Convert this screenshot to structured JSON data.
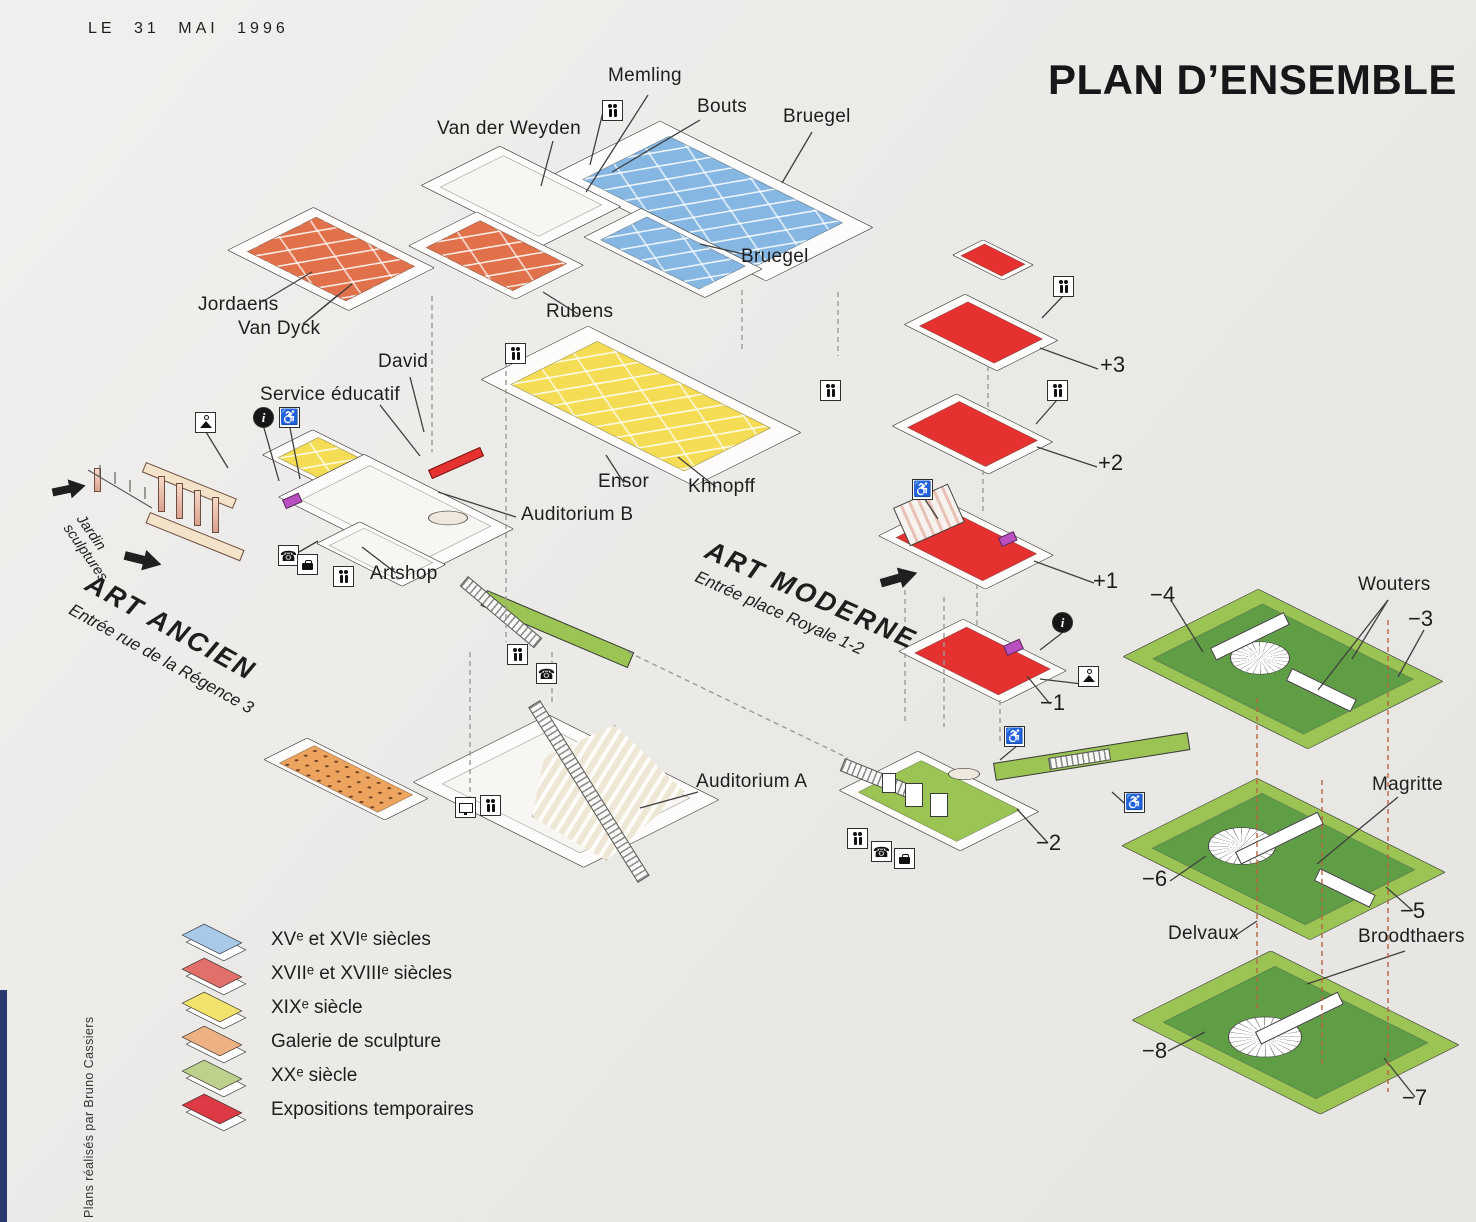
{
  "page": {
    "date": "LE 31 MAI 1996",
    "title": "PLAN D’ENSEMBLE",
    "credit": "Plans réalisés par Bruno Cassiers"
  },
  "art_ancien": {
    "name": "ART ANCIEN",
    "entrance": "Entrée rue de la Régence 3",
    "garden": "Jardin sculptures",
    "rooms": {
      "memling": "Memling",
      "bouts": "Bouts",
      "bruegel_top": "Bruegel",
      "van_der_weyden": "Van der Weyden",
      "bruegel_lower": "Bruegel",
      "jordaens": "Jordaens",
      "van_dyck": "Van Dyck",
      "rubens": "Rubens",
      "david": "David",
      "service_educatif": "Service éducatif",
      "ensor": "Ensor",
      "khnopff": "Khnopff",
      "auditorium_b": "Auditorium B",
      "artshop": "Artshop",
      "auditorium_a": "Auditorium A"
    }
  },
  "art_moderne": {
    "name": "ART MODERNE",
    "entrance": "Entrée place Royale 1-2",
    "floors": {
      "p3": "+3",
      "p2": "+2",
      "p1": "+1",
      "m1": "−1",
      "m2": "−2",
      "m3": "−3",
      "m4": "−4",
      "m5": "−5",
      "m6": "−6",
      "m7": "−7",
      "m8": "−8"
    },
    "rooms": {
      "wouters": "Wouters",
      "magritte": "Magritte",
      "delvaux": "Delvaux",
      "broodthaers": "Broodthaers"
    }
  },
  "legend": {
    "items": [
      {
        "label": "XVᵉ et XVIᵉ siècles",
        "color": "#a9c9e8"
      },
      {
        "label": "XVIIᵉ et XVIIIᵉ siècles",
        "color": "#e2706a"
      },
      {
        "label": "XIXᵉ siècle",
        "color": "#f2e36e"
      },
      {
        "label": "Galerie de sculpture",
        "color": "#eeb183"
      },
      {
        "label": "XXᵉ siècle",
        "color": "#bdd08c"
      },
      {
        "label": "Expositions temporaires",
        "color": "#de3a45"
      }
    ]
  },
  "palette": {
    "blue": "#85b7e2",
    "xvii": "#e0714b",
    "yellow": "#f4dd55",
    "sculpture": "#eda45f",
    "green": "#9cc455",
    "green_dark": "#5f9e45",
    "expo": "#e5312f",
    "magenta": "#b94fc1",
    "white_floor": "#f8f6f2"
  },
  "icons": {
    "info": "i",
    "wheelchair": "♿",
    "phone": "☎"
  }
}
